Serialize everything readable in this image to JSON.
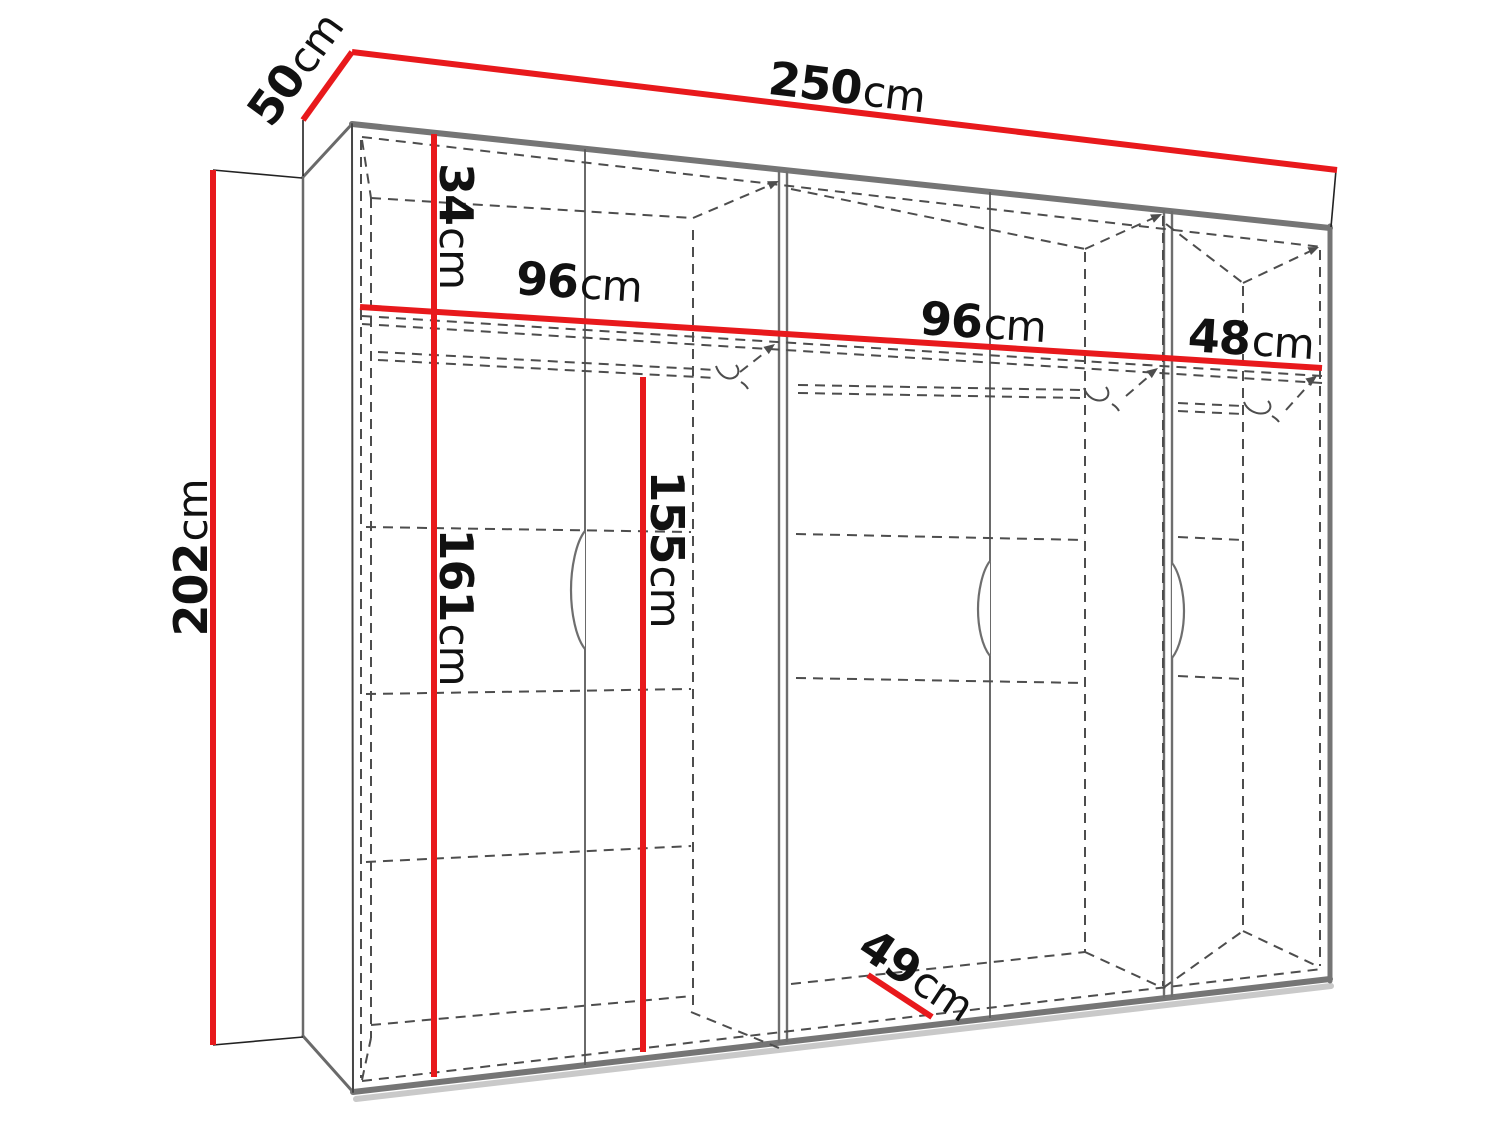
{
  "diagram": {
    "title": "wardrobe-dimension-drawing",
    "unit": "cm",
    "measurements": {
      "total_width": {
        "value": "250",
        "unit": "cm"
      },
      "top_depth": {
        "value": "50",
        "unit": "cm"
      },
      "total_height": {
        "value": "202",
        "unit": "cm"
      },
      "top_shelf_height": {
        "value": "34",
        "unit": "cm"
      },
      "section_left_width": {
        "value": "96",
        "unit": "cm"
      },
      "section_middle_width": {
        "value": "96",
        "unit": "cm"
      },
      "section_right_width": {
        "value": "48",
        "unit": "cm"
      },
      "interior_height_left": {
        "value": "161",
        "unit": "cm"
      },
      "interior_height_door": {
        "value": "155",
        "unit": "cm"
      },
      "interior_depth": {
        "value": "49",
        "unit": "cm"
      }
    },
    "colors": {
      "dimension_line": "#e8191c",
      "edge_gray": "#757575",
      "dash_gray": "#4d4d4d",
      "text": "#111111",
      "background": "#ffffff"
    }
  }
}
